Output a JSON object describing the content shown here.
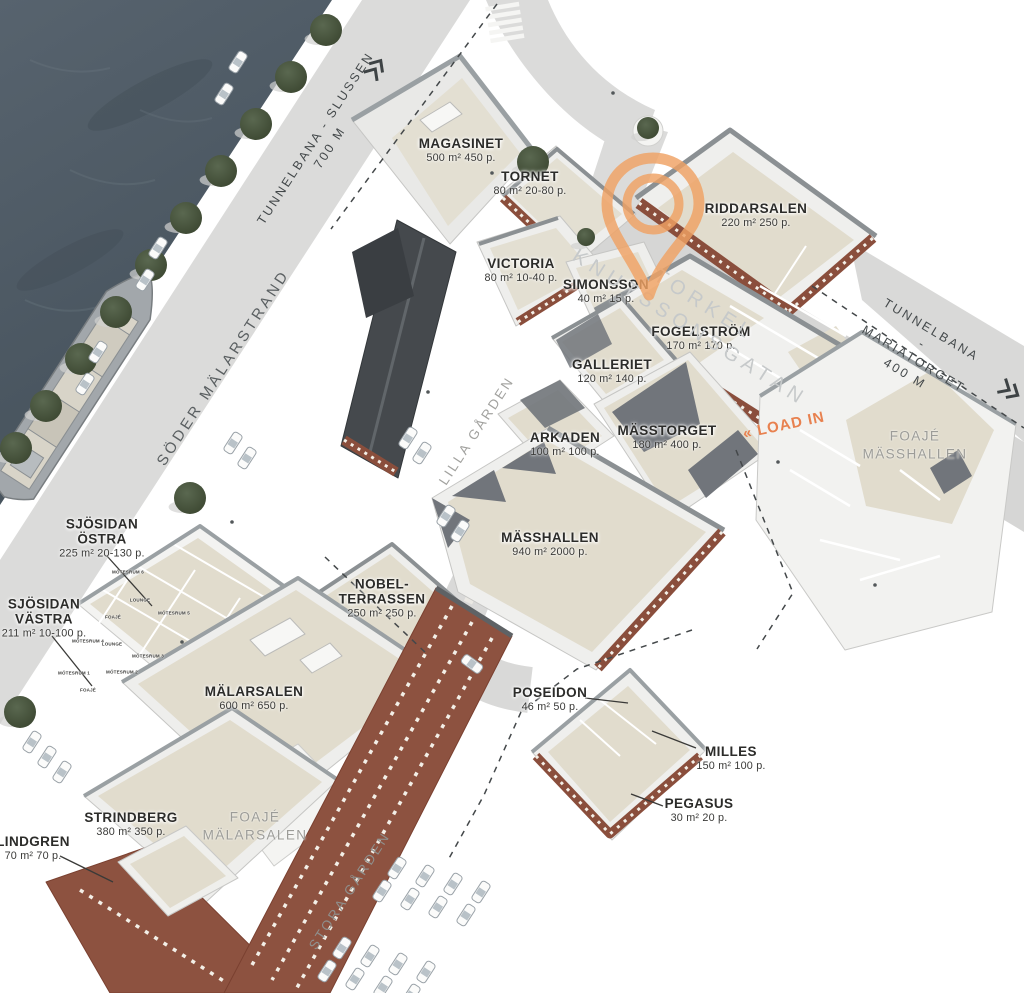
{
  "venues": [
    {
      "id": "magasinet",
      "name": "MAGASINET",
      "details": "500 m² 450 p."
    },
    {
      "id": "tornet",
      "name": "TORNET",
      "details": "80 m² 20-80 p."
    },
    {
      "id": "victoria",
      "name": "VICTORIA",
      "details": "80 m² 10-40 p."
    },
    {
      "id": "simonsson",
      "name": "SIMONSSON",
      "details": "40 m² 15 p."
    },
    {
      "id": "riddarsalen",
      "name": "RIDDARSALEN",
      "details": "220 m² 250 p."
    },
    {
      "id": "fogelstrom",
      "name": "FOGELSTRÖM",
      "details": "170 m² 170 p."
    },
    {
      "id": "galleriet",
      "name": "GALLERIET",
      "details": "120 m² 140 p."
    },
    {
      "id": "arkaden",
      "name": "ARKADEN",
      "details": "100 m² 100 p."
    },
    {
      "id": "masstorget",
      "name": "MÄSSTORGET",
      "details": "180 m² 400 p."
    },
    {
      "id": "masshallen",
      "name": "MÄSSHALLEN",
      "details": "940 m² 2000 p."
    },
    {
      "id": "sjosidan-ostra",
      "name": "SJÖSIDAN\nÖSTRA",
      "details": "225 m² 20-130 p."
    },
    {
      "id": "sjosidan-vastra",
      "name": "SJÖSIDAN\nVÄSTRA",
      "details": "211 m² 10-100 p."
    },
    {
      "id": "nobelterrassen",
      "name": "NOBEL-\nTERRASSEN",
      "details": "250 m² 250 p."
    },
    {
      "id": "malarsalen",
      "name": "MÄLARSALEN",
      "details": "600 m² 650 p."
    },
    {
      "id": "strindberg",
      "name": "STRINDBERG",
      "details": "380 m² 350 p."
    },
    {
      "id": "lindgren",
      "name": "LINDGREN",
      "details": "70 m² 70 p."
    },
    {
      "id": "poseidon",
      "name": "POSEIDON",
      "details": "46 m² 50 p."
    },
    {
      "id": "milles",
      "name": "MILLES",
      "details": "150 m² 100 p."
    },
    {
      "id": "pegasus",
      "name": "PEGASUS",
      "details": "30 m² 20 p."
    }
  ],
  "foyers": [
    {
      "id": "foaje-masshallen",
      "name": "FOAJÉ\nMÄSSHALLEN"
    },
    {
      "id": "foaje-malarsalen",
      "name": "FOAJÉ\nMÄLARSALEN"
    }
  ],
  "streets": {
    "slussen": "TUNNELBANA - SLUSSEN\n700 M",
    "soder_malarstrand": "SÖDER MÄLARSTRAND",
    "torkel": "TORKEL KNUTSSONSGATAN",
    "mariatorget": "TUNNELBANA - MARIATORGET\n400 M",
    "lilla_garden": "LILLA GÅRDEN",
    "stora_garden": "STORA GÅRDEN",
    "load_in": "« LOAD IN"
  },
  "small_rooms": [
    "MÖTESRUM 6",
    "LOUNGE",
    "MÖTESRUM 5",
    "FOAJÉ",
    "MÖTESRUM 4",
    "LOUNGE",
    "MÖTESRUM 3",
    "MÖTESRUM 2",
    "MÖTESRUM 1",
    "FOAJÉ"
  ],
  "marker": {
    "name": "location-pin",
    "color": "#F0A264"
  },
  "colors": {
    "water": "#4D5B66",
    "street": "#DBDBDA",
    "floor_beige": "#E1DCCD",
    "building_white": "#EFEFED",
    "brick": "#8A4E3C",
    "roof_dark": "#71757B",
    "tree": "#414C38",
    "accent_orange": "#E8814F",
    "label_dark": "#2C2C2A",
    "label_gray": "#9C9C98"
  }
}
